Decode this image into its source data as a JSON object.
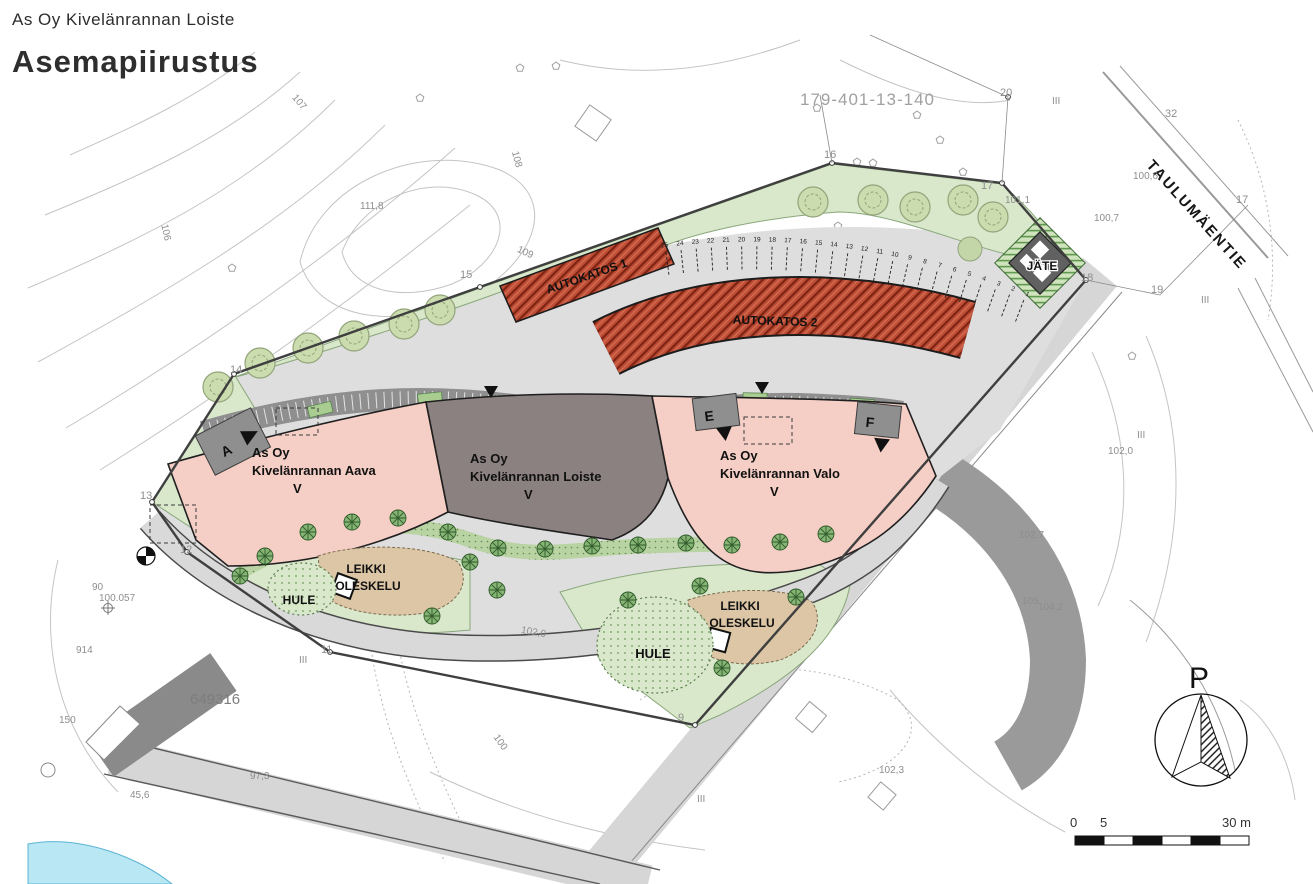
{
  "header": {
    "project": "As Oy Kivelänrannan Loiste",
    "title": "Asemapiirustus"
  },
  "map": {
    "parcel_id": "179-401-13-140",
    "street_name": "TAULUMÄENTIE",
    "carport1": "AUTOKATOS 1",
    "carport2": "AUTOKATOS 2",
    "waste_shed": "JÄTE",
    "buildings": {
      "aava": {
        "l1": "As Oy",
        "l2": "Kivelänrannan Aava",
        "l3": "V"
      },
      "loiste": {
        "l1": "As Oy",
        "l2": "Kivelänrannan Loiste",
        "l3": "V"
      },
      "valo": {
        "l1": "As Oy",
        "l2": "Kivelänrannan Valo",
        "l3": "V"
      }
    },
    "play_left": {
      "l1": "LEIKKI",
      "l2": "OLESKELU"
    },
    "play_right": {
      "l1": "LEIKKI",
      "l2": "OLESKELU"
    },
    "hule_left": "HULE",
    "hule_right": "HULE",
    "entrances": {
      "a": "A",
      "e": "E",
      "f": "F"
    },
    "elevations": {
      "peak": "111,8",
      "v101_1": "101,1",
      "v100_6": "100,6",
      "v100_7": "100,7",
      "v102_0": "102,0",
      "v102_7": "102,7",
      "v105": "105",
      "v104_2": "104,2",
      "v102_3": "102,3",
      "v97_3": "97,3",
      "v90": "90",
      "v100_057": "100.057",
      "v914": "914",
      "v150": "150",
      "v45_6": "45,6",
      "building_id": "649316"
    },
    "contour_labels": {
      "c106": "106",
      "c107": "107",
      "c108": "108",
      "c109": "109",
      "c100": "100",
      "c102": "102,0"
    },
    "parcel_points": {
      "p9": "9",
      "p11": "11",
      "p12": "12",
      "p13": "13",
      "p14": "14",
      "p15": "15",
      "p16": "16",
      "p17": "17",
      "p17b": "17",
      "p18": "18",
      "p19": "19",
      "p20": "20",
      "p32": "32"
    },
    "roman": {
      "r1": "III",
      "r2": "III",
      "r3": "III",
      "r4": "III",
      "r5": "III"
    },
    "parking": {
      "open_row": [
        25,
        24,
        23,
        22,
        21,
        20,
        19,
        18,
        17,
        16,
        15,
        14,
        13,
        12,
        11,
        10,
        9,
        8,
        7,
        6,
        5,
        4,
        3,
        2,
        1
      ],
      "carport1_stall_range": "26–44",
      "carport2_stall_range": "45–89",
      "covered_row_stall_range": "90–105"
    },
    "north_label": "P",
    "scalebar": {
      "zero": "0",
      "five": "5",
      "thirty": "30 m"
    }
  },
  "colors": {
    "building_pink": "#f5cfc5",
    "building_taupe": "#8b8180",
    "carport_red": "#c14f36",
    "green_area": "#d9e7cb",
    "verge_green": "#b9d3a3",
    "asphalt": "#dedede",
    "dark_band": "#8f8f8f",
    "play_tan": "#dcc6a6",
    "lake_blue": "#b9e7f4"
  }
}
